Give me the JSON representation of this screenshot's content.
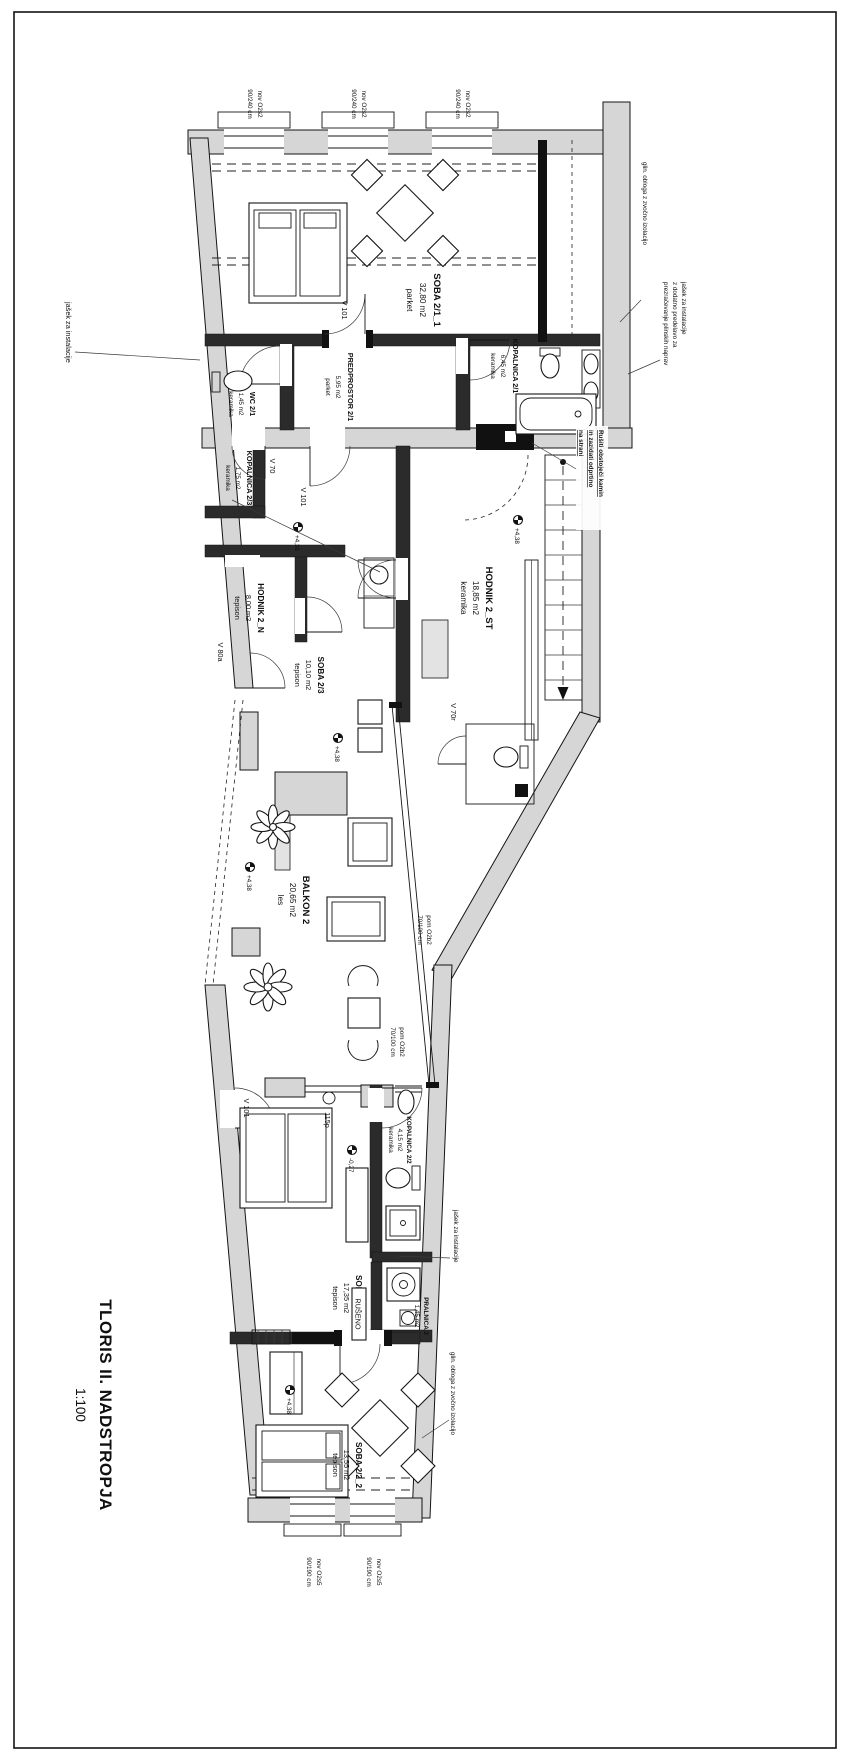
{
  "page": {
    "title_line1": "TLORIS II. NADSTROPJA",
    "title_line2": "1:100"
  },
  "rooms": {
    "soba211": {
      "name": "SOBA 2/1_1",
      "area": "32,80 m2",
      "floor": "parket"
    },
    "wc21": {
      "name": "WC 2/1",
      "area": "1,45 m2",
      "floor": "keramika"
    },
    "predprostor21": {
      "name": "PREDPROSTOR 2/1",
      "area": "5,95 m2",
      "floor": "parket"
    },
    "kopalnica21": {
      "name": "KOPALNICA 2/1",
      "area": "6,45 m2",
      "floor": "keramika"
    },
    "kopalnica23": {
      "name": "KOPALNICA 2/3",
      "area": "1,75 m2",
      "floor": "keramika"
    },
    "hodnik2st": {
      "name": "HODNIK 2_ST",
      "area": "18,85 m2",
      "floor": "keramika"
    },
    "hodnik2n": {
      "name": "HODNIK 2_N",
      "area": "8,00 m2",
      "floor": "tepison"
    },
    "soba23": {
      "name": "SOBA 2/3",
      "area": "10,10 m2",
      "floor": "tepison"
    },
    "balkon2": {
      "name": "BALKON 2",
      "area": "20,65 m2",
      "floor": "les"
    },
    "kopalnica22": {
      "name": "KOPALNICA 2/2",
      "area": "4,15 m2",
      "floor": "keramika"
    },
    "pralnica2": {
      "name": "PRALNICA 2",
      "area": "1,45 m2",
      "floor": "keramika"
    },
    "soba221": {
      "name": "SOBA 2/2_1",
      "area": "17,35 m2",
      "floor": "tepison"
    },
    "soba222": {
      "name": "SOBA 2/2_2",
      "area": "13,55 m2",
      "floor": "tepison"
    }
  },
  "marks": {
    "v101": "V 101",
    "v70": "V 70",
    "v70r": "V 70r",
    "v80a": "V 80a",
    "o115p": "115p",
    "ruseno": "RUŠENO"
  },
  "levels": {
    "plus438": "+4,38",
    "minus027": "-0,27"
  },
  "annotations": {
    "shaft": "jašek za instalacije",
    "shaft_long_1": "jašek za instalacije",
    "shaft_long_2": "z dodatno predelavo za",
    "shaft_long_3": "prezračevanje plinskih naprav",
    "sound": "glin. obloga z zvočno izolacijo",
    "demol_1": "Rušiti obstoječi kamin",
    "demol_2": "in zazidati odprtino",
    "demol_3": "na strani"
  },
  "window_labels": {
    "top1": "nov O2s2",
    "top2": "90/240 cm",
    "bottom1": "nov O2s5",
    "bottom2": "90/190 cm",
    "glass1": "pom O2b2",
    "glass2": "70/100 cm"
  }
}
